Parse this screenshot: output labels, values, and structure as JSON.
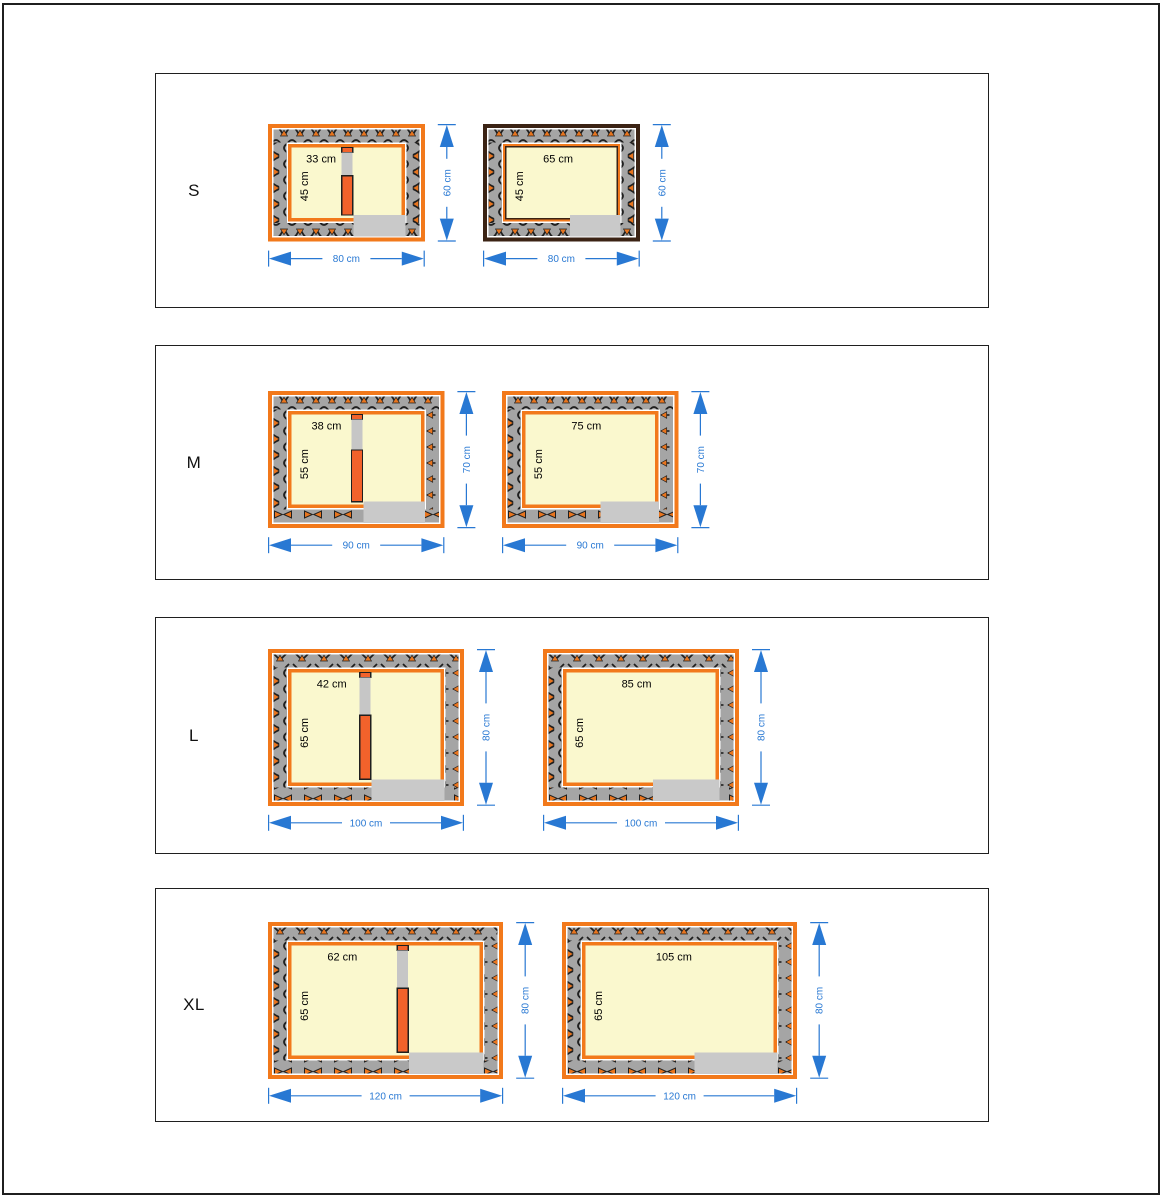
{
  "colors": {
    "frame_orange": "#F2791B",
    "frame_dark_brown": "#3B2314",
    "divider_orange": "#F2622B",
    "wall_gray": "#A5A5A5",
    "hatch_dark": "#1F1F1F",
    "hatch_orange": "#E8751F",
    "interior_cream": "#FAF8CE",
    "entrance_gray": "#C9C9C9",
    "dimension_blue": "#2878D3",
    "border_black": "#1F1F1F"
  },
  "rows": [
    {
      "label": "S",
      "boxes": [
        {
          "kind": "divided",
          "frame": "orange",
          "width_cm": 80,
          "height_cm": 60,
          "interior_width_cm": 65,
          "compartment_width_cm": 33,
          "top_label": "33 cm",
          "side_label": "45 cm",
          "width_label": "80 cm",
          "height_label": "60 cm"
        },
        {
          "kind": "open",
          "frame": "dark",
          "width_cm": 80,
          "height_cm": 60,
          "interior_width_cm": 65,
          "top_label": "65 cm",
          "side_label": "45 cm",
          "width_label": "80 cm",
          "height_label": "60 cm"
        }
      ]
    },
    {
      "label": "M",
      "boxes": [
        {
          "kind": "divided",
          "frame": "orange",
          "width_cm": 90,
          "height_cm": 70,
          "interior_width_cm": 75,
          "compartment_width_cm": 38,
          "top_label": "38 cm",
          "side_label": "55 cm",
          "width_label": "90 cm",
          "height_label": "70 cm"
        },
        {
          "kind": "open",
          "frame": "orange",
          "width_cm": 90,
          "height_cm": 70,
          "interior_width_cm": 75,
          "top_label": "75 cm",
          "side_label": "55 cm",
          "width_label": "90 cm",
          "height_label": "70 cm"
        }
      ]
    },
    {
      "label": "L",
      "boxes": [
        {
          "kind": "divided",
          "frame": "orange",
          "width_cm": 100,
          "height_cm": 80,
          "interior_width_cm": 85,
          "compartment_width_cm": 42,
          "top_label": "42 cm",
          "side_label": "65 cm",
          "width_label": "100 cm",
          "height_label": "80 cm"
        },
        {
          "kind": "open",
          "frame": "orange",
          "width_cm": 100,
          "height_cm": 80,
          "interior_width_cm": 85,
          "top_label": "85 cm",
          "side_label": "65 cm",
          "width_label": "100 cm",
          "height_label": "80 cm"
        }
      ]
    },
    {
      "label": "XL",
      "boxes": [
        {
          "kind": "divided",
          "frame": "orange",
          "width_cm": 120,
          "height_cm": 80,
          "interior_width_cm": 105,
          "compartment_width_cm": 62,
          "top_label": "62 cm",
          "side_label": "65 cm",
          "width_label": "120 cm",
          "height_label": "80 cm"
        },
        {
          "kind": "open",
          "frame": "orange",
          "width_cm": 120,
          "height_cm": 80,
          "interior_width_cm": 105,
          "top_label": "105 cm",
          "side_label": "65 cm",
          "width_label": "120 cm",
          "height_label": "80 cm"
        }
      ]
    }
  ]
}
